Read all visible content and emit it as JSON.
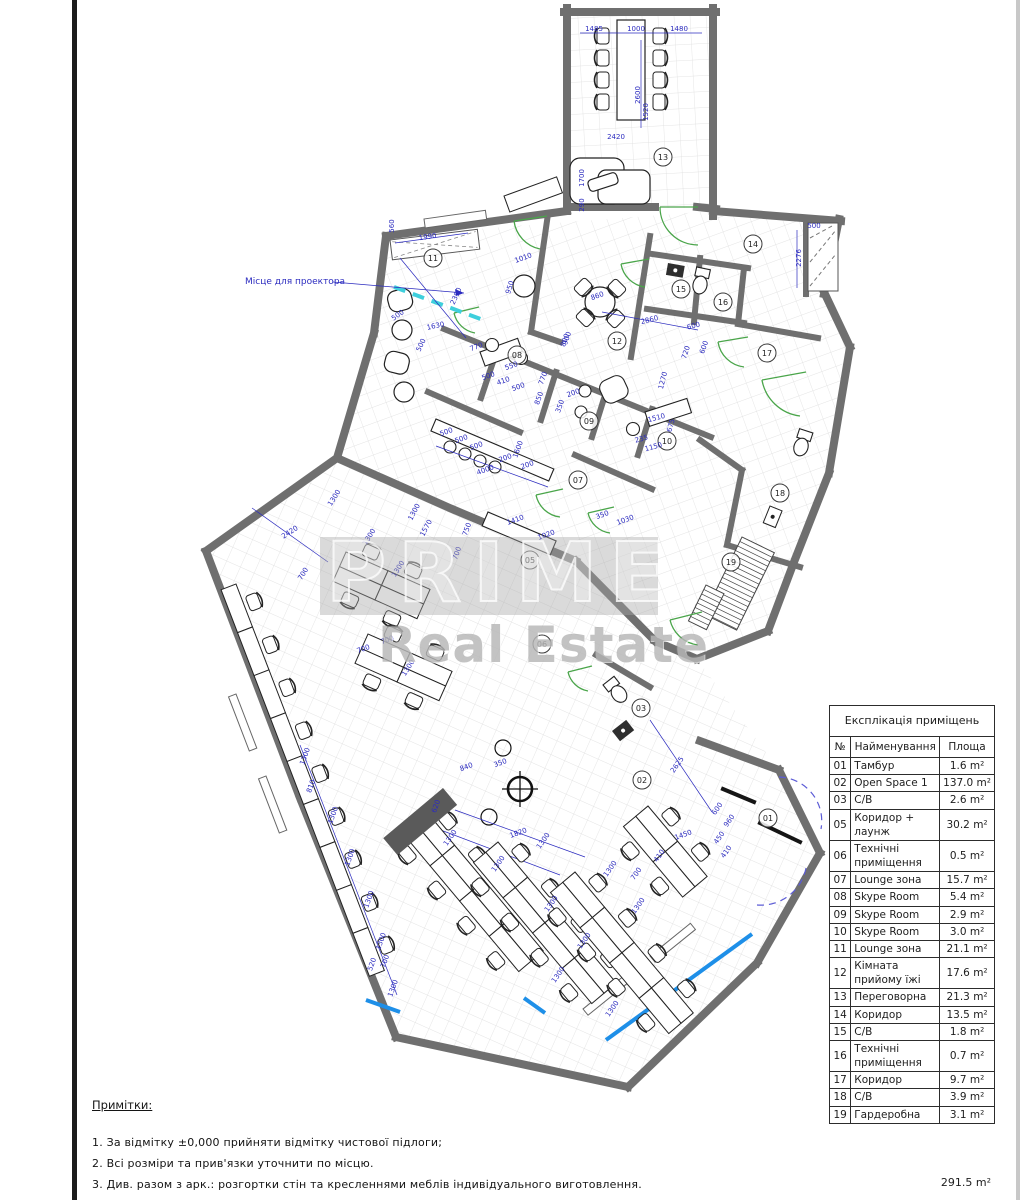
{
  "projector_label": "Місце для проектора",
  "watermark": {
    "line1": "PRIMES",
    "line2": "Real Estate"
  },
  "legend_table": {
    "title": "Експлікація приміщень",
    "headers": [
      "№",
      "Найменування",
      "Площа"
    ],
    "rows": [
      {
        "no": "01",
        "name": "Тамбур",
        "area": "1.6 m²"
      },
      {
        "no": "02",
        "name": "Open Space 1",
        "area": "137.0 m²"
      },
      {
        "no": "03",
        "name": "С/В",
        "area": "2.6 m²"
      },
      {
        "no": "05",
        "name": "Коридор + лаунж",
        "area": "30.2 m²"
      },
      {
        "no": "06",
        "name": "Технічні приміщення",
        "area": "0.5 m²"
      },
      {
        "no": "07",
        "name": "Lounge зона",
        "area": "15.7 m²"
      },
      {
        "no": "08",
        "name": "Skype Room",
        "area": "5.4 m²"
      },
      {
        "no": "09",
        "name": "Skype Room",
        "area": "2.9 m²"
      },
      {
        "no": "10",
        "name": "Skype Room",
        "area": "3.0 m²"
      },
      {
        "no": "11",
        "name": "Lounge зона",
        "area": "21.1 m²"
      },
      {
        "no": "12",
        "name": "Кімната прийому їжі",
        "area": "17.6 m²"
      },
      {
        "no": "13",
        "name": "Переговорна",
        "area": "21.3 m²"
      },
      {
        "no": "14",
        "name": "Коридор",
        "area": "13.5 m²"
      },
      {
        "no": "15",
        "name": "С/В",
        "area": "1.8 m²"
      },
      {
        "no": "16",
        "name": "Технічні приміщення",
        "area": "0.7 m²"
      },
      {
        "no": "17",
        "name": "Коридор",
        "area": "9.7 m²"
      },
      {
        "no": "18",
        "name": "С/В",
        "area": "3.9 m²"
      },
      {
        "no": "19",
        "name": "Гардеробна",
        "area": "3.1 m²"
      }
    ],
    "total": "291.5 m²"
  },
  "notes": {
    "title": "Примітки:",
    "items": [
      "1. За відмітку ±0,000 прийняти відмітку чистової підлоги;",
      "2. Всі розміри та прив'язки уточнити по місцю.",
      "3. Див. разом з арк.: розгортки стін та кресленнями меблів індивідуального виготовлення."
    ]
  },
  "room_labels": [
    {
      "n": "01",
      "x": 768,
      "y": 818
    },
    {
      "n": "02",
      "x": 642,
      "y": 780
    },
    {
      "n": "03",
      "x": 641,
      "y": 708
    },
    {
      "n": "05",
      "x": 530,
      "y": 560
    },
    {
      "n": "06",
      "x": 542,
      "y": 644
    },
    {
      "n": "07",
      "x": 578,
      "y": 480
    },
    {
      "n": "08",
      "x": 517,
      "y": 355
    },
    {
      "n": "09",
      "x": 589,
      "y": 421
    },
    {
      "n": "10",
      "x": 667,
      "y": 441
    },
    {
      "n": "11",
      "x": 433,
      "y": 258
    },
    {
      "n": "12",
      "x": 617,
      "y": 341
    },
    {
      "n": "13",
      "x": 663,
      "y": 157
    },
    {
      "n": "14",
      "x": 753,
      "y": 244
    },
    {
      "n": "15",
      "x": 681,
      "y": 289
    },
    {
      "n": "16",
      "x": 723,
      "y": 302
    },
    {
      "n": "17",
      "x": 767,
      "y": 353
    },
    {
      "n": "18",
      "x": 780,
      "y": 493
    },
    {
      "n": "19",
      "x": 731,
      "y": 562
    }
  ],
  "dimensions": [
    {
      "t": "1485",
      "x": 594,
      "y": 31,
      "r": 0
    },
    {
      "t": "1000",
      "x": 636,
      "y": 31,
      "r": 0
    },
    {
      "t": "1480",
      "x": 679,
      "y": 31,
      "r": 0
    },
    {
      "t": "2600",
      "x": 640,
      "y": 95,
      "r": -90
    },
    {
      "t": "2420",
      "x": 616,
      "y": 139,
      "r": 0
    },
    {
      "t": "1520",
      "x": 648,
      "y": 112,
      "r": -90
    },
    {
      "t": "1700",
      "x": 584,
      "y": 178,
      "r": -90
    },
    {
      "t": "290",
      "x": 584,
      "y": 205,
      "r": -90
    },
    {
      "t": "560",
      "x": 394,
      "y": 226,
      "r": -90
    },
    {
      "t": "1990",
      "x": 428,
      "y": 239,
      "r": -8
    },
    {
      "t": "2390",
      "x": 458,
      "y": 297,
      "r": -65
    },
    {
      "t": "500",
      "x": 399,
      "y": 317,
      "r": -35
    },
    {
      "t": "1630",
      "x": 436,
      "y": 328,
      "r": -12
    },
    {
      "t": "500",
      "x": 423,
      "y": 346,
      "r": -65
    },
    {
      "t": "1010",
      "x": 524,
      "y": 260,
      "r": -20
    },
    {
      "t": "950",
      "x": 512,
      "y": 288,
      "r": -72
    },
    {
      "t": "860",
      "x": 598,
      "y": 298,
      "r": -20
    },
    {
      "t": "800",
      "x": 567,
      "y": 341,
      "r": -70
    },
    {
      "t": "2860",
      "x": 650,
      "y": 322,
      "r": -14
    },
    {
      "t": "600",
      "x": 694,
      "y": 328,
      "r": -14
    },
    {
      "t": "600",
      "x": 706,
      "y": 348,
      "r": -70
    },
    {
      "t": "720",
      "x": 688,
      "y": 353,
      "r": -72
    },
    {
      "t": "500",
      "x": 814,
      "y": 228,
      "r": 0
    },
    {
      "t": "2276",
      "x": 801,
      "y": 258,
      "r": -90
    },
    {
      "t": "770",
      "x": 477,
      "y": 349,
      "r": -20
    },
    {
      "t": "550",
      "x": 512,
      "y": 368,
      "r": -20
    },
    {
      "t": "500",
      "x": 489,
      "y": 378,
      "r": -20
    },
    {
      "t": "410",
      "x": 504,
      "y": 383,
      "r": -20
    },
    {
      "t": "500",
      "x": 519,
      "y": 389,
      "r": -20
    },
    {
      "t": "770",
      "x": 545,
      "y": 379,
      "r": -70
    },
    {
      "t": "850",
      "x": 541,
      "y": 399,
      "r": -70
    },
    {
      "t": "350",
      "x": 562,
      "y": 407,
      "r": -70
    },
    {
      "t": "200",
      "x": 574,
      "y": 395,
      "r": -20
    },
    {
      "t": "900",
      "x": 569,
      "y": 339,
      "r": -70
    },
    {
      "t": "1270",
      "x": 665,
      "y": 381,
      "r": -75
    },
    {
      "t": "1510",
      "x": 657,
      "y": 420,
      "r": -15
    },
    {
      "t": "675",
      "x": 673,
      "y": 426,
      "r": -75
    },
    {
      "t": "235",
      "x": 642,
      "y": 441,
      "r": -15
    },
    {
      "t": "1150",
      "x": 654,
      "y": 449,
      "r": -15
    },
    {
      "t": "500",
      "x": 447,
      "y": 434,
      "r": -20
    },
    {
      "t": "500",
      "x": 462,
      "y": 441,
      "r": -20
    },
    {
      "t": "500",
      "x": 477,
      "y": 448,
      "r": -20
    },
    {
      "t": "200",
      "x": 506,
      "y": 460,
      "r": -20
    },
    {
      "t": "200",
      "x": 528,
      "y": 467,
      "r": -20
    },
    {
      "t": "4000",
      "x": 486,
      "y": 472,
      "r": -20
    },
    {
      "t": "1600",
      "x": 520,
      "y": 450,
      "r": -70
    },
    {
      "t": "1410",
      "x": 516,
      "y": 522,
      "r": -20
    },
    {
      "t": "1020",
      "x": 547,
      "y": 537,
      "r": -20
    },
    {
      "t": "750",
      "x": 469,
      "y": 530,
      "r": -70
    },
    {
      "t": "700",
      "x": 459,
      "y": 554,
      "r": -70
    },
    {
      "t": "1570",
      "x": 428,
      "y": 529,
      "r": -62
    },
    {
      "t": "1300",
      "x": 416,
      "y": 513,
      "r": -62
    },
    {
      "t": "350",
      "x": 603,
      "y": 517,
      "r": -20
    },
    {
      "t": "1030",
      "x": 626,
      "y": 522,
      "r": -20
    },
    {
      "t": "2420",
      "x": 291,
      "y": 534,
      "r": -33
    },
    {
      "t": "1300",
      "x": 336,
      "y": 499,
      "r": -58
    },
    {
      "t": "1300",
      "x": 371,
      "y": 538,
      "r": -58
    },
    {
      "t": "1300",
      "x": 400,
      "y": 570,
      "r": -58
    },
    {
      "t": "700",
      "x": 305,
      "y": 575,
      "r": -58
    },
    {
      "t": "700",
      "x": 364,
      "y": 651,
      "r": -20
    },
    {
      "t": "700",
      "x": 388,
      "y": 642,
      "r": -20
    },
    {
      "t": "1300",
      "x": 410,
      "y": 669,
      "r": -58
    },
    {
      "t": "1300",
      "x": 307,
      "y": 757,
      "r": -70
    },
    {
      "t": "810",
      "x": 313,
      "y": 787,
      "r": -70
    },
    {
      "t": "1300",
      "x": 335,
      "y": 816,
      "r": -70
    },
    {
      "t": "1300",
      "x": 352,
      "y": 858,
      "r": -70
    },
    {
      "t": "1300",
      "x": 371,
      "y": 900,
      "r": -70
    },
    {
      "t": "1300",
      "x": 383,
      "y": 942,
      "r": -70
    },
    {
      "t": "520",
      "x": 374,
      "y": 965,
      "r": -70
    },
    {
      "t": "700",
      "x": 387,
      "y": 962,
      "r": -70
    },
    {
      "t": "1300",
      "x": 395,
      "y": 989,
      "r": -70
    },
    {
      "t": "840",
      "x": 467,
      "y": 769,
      "r": -20
    },
    {
      "t": "350",
      "x": 501,
      "y": 765,
      "r": -20
    },
    {
      "t": "620",
      "x": 438,
      "y": 807,
      "r": -70
    },
    {
      "t": "1300",
      "x": 452,
      "y": 839,
      "r": -55
    },
    {
      "t": "1820",
      "x": 519,
      "y": 835,
      "r": -20
    },
    {
      "t": "2625",
      "x": 679,
      "y": 766,
      "r": -55
    },
    {
      "t": "1450",
      "x": 684,
      "y": 837,
      "r": -20
    },
    {
      "t": "410",
      "x": 661,
      "y": 857,
      "r": -55
    },
    {
      "t": "700",
      "x": 638,
      "y": 875,
      "r": -55
    },
    {
      "t": "1300",
      "x": 500,
      "y": 865,
      "r": -55
    },
    {
      "t": "1300",
      "x": 545,
      "y": 842,
      "r": -55
    },
    {
      "t": "1300",
      "x": 612,
      "y": 870,
      "r": -55
    },
    {
      "t": "1300",
      "x": 553,
      "y": 905,
      "r": -55
    },
    {
      "t": "1300",
      "x": 640,
      "y": 907,
      "r": -55
    },
    {
      "t": "1300",
      "x": 586,
      "y": 942,
      "r": -55
    },
    {
      "t": "1300",
      "x": 560,
      "y": 976,
      "r": -55
    },
    {
      "t": "1300",
      "x": 614,
      "y": 1010,
      "r": -55
    },
    {
      "t": "600",
      "x": 719,
      "y": 810,
      "r": -55
    },
    {
      "t": "960",
      "x": 731,
      "y": 822,
      "r": -55
    },
    {
      "t": "450",
      "x": 721,
      "y": 839,
      "r": -55
    },
    {
      "t": "410",
      "x": 728,
      "y": 853,
      "r": -55
    }
  ],
  "colors": {
    "dimension_blue": "#2b2bbf",
    "wall_gray": "#6f6f6f",
    "door_green": "#4aa54a",
    "projector_cyan": "#3ecfdc",
    "window_blue": "#1e8fe8"
  }
}
